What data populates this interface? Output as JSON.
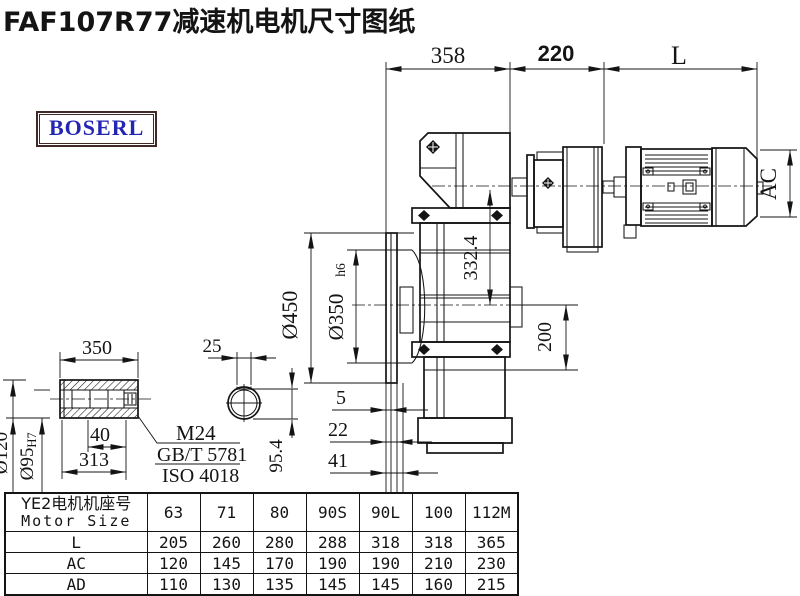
{
  "title": "FAF107R77减速机电机尺寸图纸",
  "logo": {
    "text": "BOSERL"
  },
  "colors": {
    "ink": "#141414",
    "logo_text": "#2525b4",
    "logo_border": "#402a28",
    "background": "#ffffff"
  },
  "drawing": {
    "dims": {
      "flange_to_adapter": "358",
      "adapter_length": "220",
      "motor_length": "L",
      "motor_diameter": "AC",
      "center_height": "332.4",
      "center_to_base": "200",
      "flange_od": "Ø450",
      "flange_spigot": "Ø350",
      "flange_spigot_tol": "h6",
      "flange_gap_a": "5",
      "flange_gap_b": "22",
      "flange_gap_c": "41"
    },
    "shaft": {
      "length": "350",
      "outer_dia": "Ø120",
      "bore_dia": "Ø95",
      "bore_tol": "H7",
      "thread_depth": "40",
      "bore_depth": "313",
      "key_width": "25",
      "key_height": "95.4",
      "thread": "M24",
      "standard_1": "GB/T 5781",
      "standard_2": "ISO 4018"
    }
  },
  "table": {
    "header_cn": "YE2电机机座号",
    "header_en": "Motor Size",
    "columns": [
      "63",
      "71",
      "80",
      "90S",
      "90L",
      "100",
      "112M"
    ],
    "rows": [
      {
        "label": "L",
        "values": [
          "205",
          "260",
          "280",
          "288",
          "318",
          "318",
          "365"
        ]
      },
      {
        "label": "AC",
        "values": [
          "120",
          "145",
          "170",
          "190",
          "190",
          "210",
          "230"
        ]
      },
      {
        "label": "AD",
        "values": [
          "110",
          "130",
          "135",
          "145",
          "145",
          "160",
          "215"
        ]
      }
    ]
  }
}
